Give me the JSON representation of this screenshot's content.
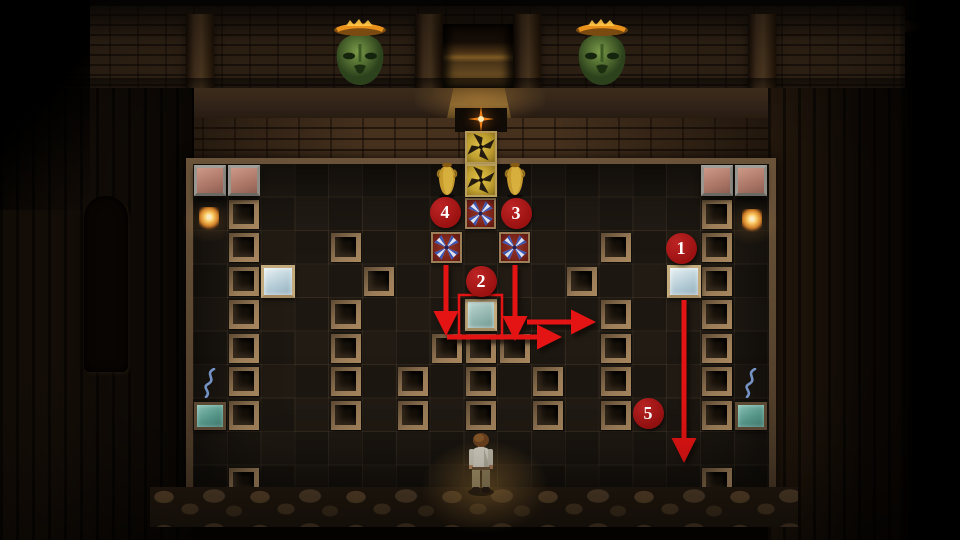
{
  "scene": {
    "description": "dark temple puzzle room with tiled pit floor",
    "doorway": {
      "x": 443,
      "y": 24,
      "w": 70,
      "h": 64
    },
    "masks": [
      {
        "x": 332,
        "y": 18
      },
      {
        "x": 574,
        "y": 18
      }
    ],
    "spark": {
      "x": 481,
      "y": 119
    },
    "torches": [
      {
        "x": 199,
        "y": 207
      },
      {
        "x": 742,
        "y": 209
      }
    ],
    "character": {
      "x": 464,
      "y": 432
    },
    "colors": {
      "mask_green": "#5c7c34",
      "flame_orange": "#e8921c",
      "gold": "#d2b23c",
      "brick_red_block": "#7c241a",
      "ice_blue": "#c6dae2",
      "teal": "#5a9c90",
      "pink_block": "#bf8a7a"
    }
  },
  "grid": {
    "origin": {
      "x": 193.3,
      "y": 164
    },
    "cell": {
      "w": 33.8,
      "h": 33.5
    },
    "cols": 17,
    "rows": 10,
    "recessed_tiles": [
      [
        1,
        1
      ],
      [
        1,
        2
      ],
      [
        1,
        3
      ],
      [
        1,
        4
      ],
      [
        1,
        5
      ],
      [
        1,
        6
      ],
      [
        1,
        7
      ],
      [
        1,
        9
      ],
      [
        4,
        2
      ],
      [
        4,
        4
      ],
      [
        4,
        5
      ],
      [
        4,
        6
      ],
      [
        4,
        7
      ],
      [
        5,
        3
      ],
      [
        6,
        6
      ],
      [
        6,
        7
      ],
      [
        7,
        5
      ],
      [
        8,
        5
      ],
      [
        8,
        6
      ],
      [
        8,
        7
      ],
      [
        9,
        5
      ],
      [
        10,
        6
      ],
      [
        10,
        7
      ],
      [
        11,
        3
      ],
      [
        12,
        2
      ],
      [
        12,
        4
      ],
      [
        12,
        5
      ],
      [
        12,
        6
      ],
      [
        12,
        7
      ],
      [
        15,
        1
      ],
      [
        15,
        2
      ],
      [
        15,
        3
      ],
      [
        15,
        4
      ],
      [
        15,
        5
      ],
      [
        15,
        6
      ],
      [
        15,
        7
      ],
      [
        15,
        9
      ]
    ],
    "pink_blocks": [
      [
        0,
        0
      ],
      [
        1,
        0
      ],
      [
        15,
        0
      ],
      [
        16,
        0
      ]
    ],
    "ice_tiles": [
      [
        2,
        3
      ],
      [
        14,
        3
      ]
    ],
    "center_ice_tile": [
      8,
      4
    ],
    "teal_tiles": [
      [
        0,
        7
      ],
      [
        16,
        7
      ]
    ],
    "snake_marks": [
      [
        0,
        6
      ],
      [
        16,
        6
      ]
    ],
    "red_pinwheel_blocks": [
      [
        8,
        1
      ],
      [
        7,
        2
      ],
      [
        9,
        2
      ]
    ],
    "gold_pinwheel_blocks": [
      [
        8,
        -1
      ],
      [
        8,
        0
      ]
    ],
    "vases": [
      [
        7,
        0
      ],
      [
        9,
        0
      ]
    ]
  },
  "overlay": {
    "markers": [
      {
        "label": "1",
        "x": 681,
        "y": 248
      },
      {
        "label": "2",
        "x": 481,
        "y": 281
      },
      {
        "label": "3",
        "x": 516,
        "y": 213
      },
      {
        "label": "4",
        "x": 445,
        "y": 212
      },
      {
        "label": "5",
        "x": 648,
        "y": 413
      }
    ],
    "arrows": [
      {
        "x1": 446,
        "y1": 265,
        "x2": 446,
        "y2": 316
      },
      {
        "x1": 515,
        "y1": 265,
        "x2": 515,
        "y2": 321
      },
      {
        "x1": 527,
        "y1": 322,
        "x2": 576,
        "y2": 322
      },
      {
        "x1": 447,
        "y1": 337,
        "x2": 542,
        "y2": 337
      },
      {
        "x1": 684,
        "y1": 300,
        "x2": 684,
        "y2": 443
      }
    ],
    "highlight_box": {
      "x": 459,
      "y": 295,
      "w": 43,
      "h": 43
    },
    "colors": {
      "marker_fill": "#9b1111",
      "marker_fill_light": "#bd2424",
      "marker_text": "#ffffff",
      "arrow": "#e51414"
    }
  }
}
